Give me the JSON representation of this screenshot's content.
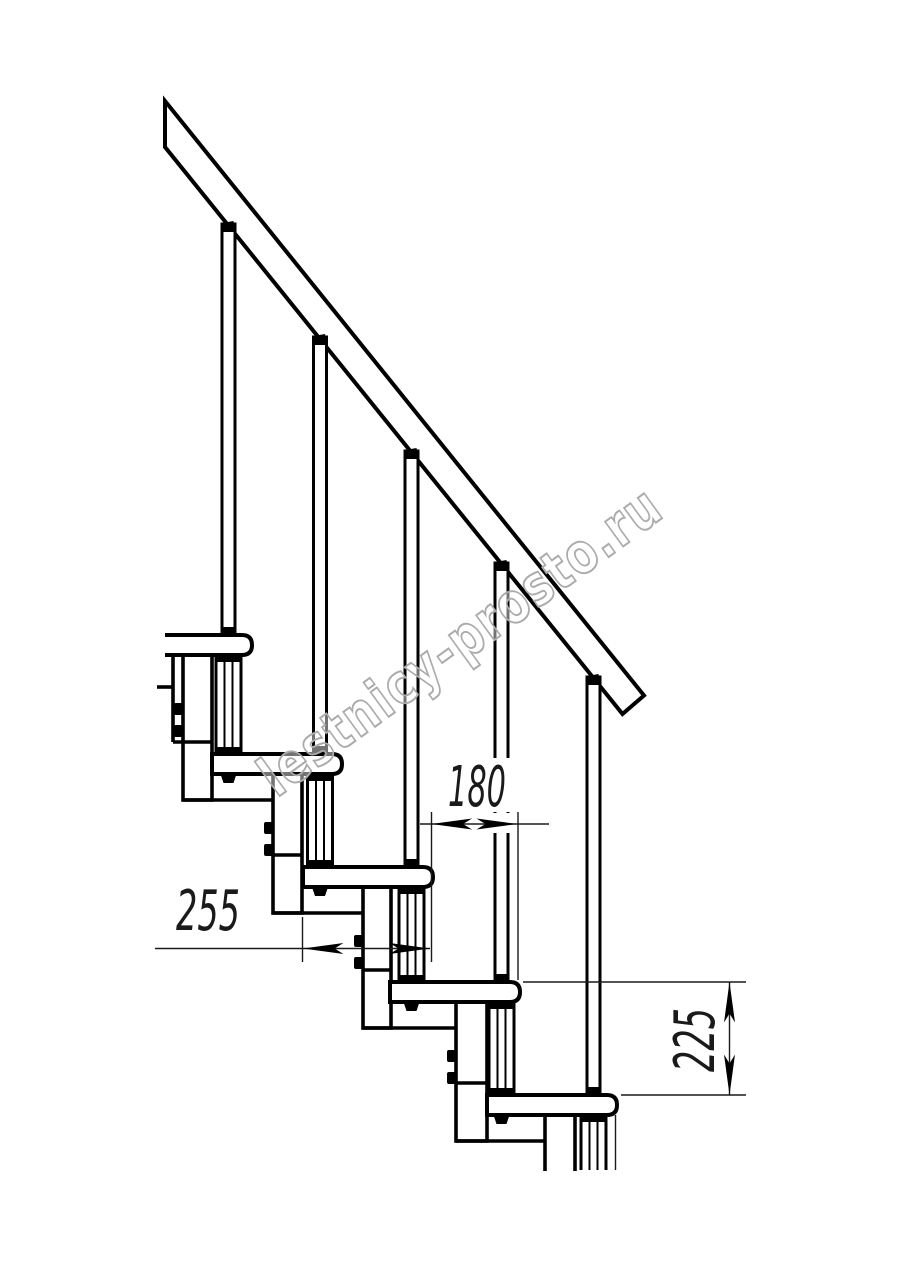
{
  "drawing": {
    "title": "Modular staircase side elevation",
    "dimensions": {
      "tread_run": "255",
      "tread_offset": "180",
      "riser_height": "225"
    },
    "watermark": "lestnicy-prosto.ru"
  },
  "colors": {
    "line": "#000000",
    "dimension_text": "#1a1a1a",
    "watermark_outline": "#ababab",
    "background": "#ffffff"
  }
}
